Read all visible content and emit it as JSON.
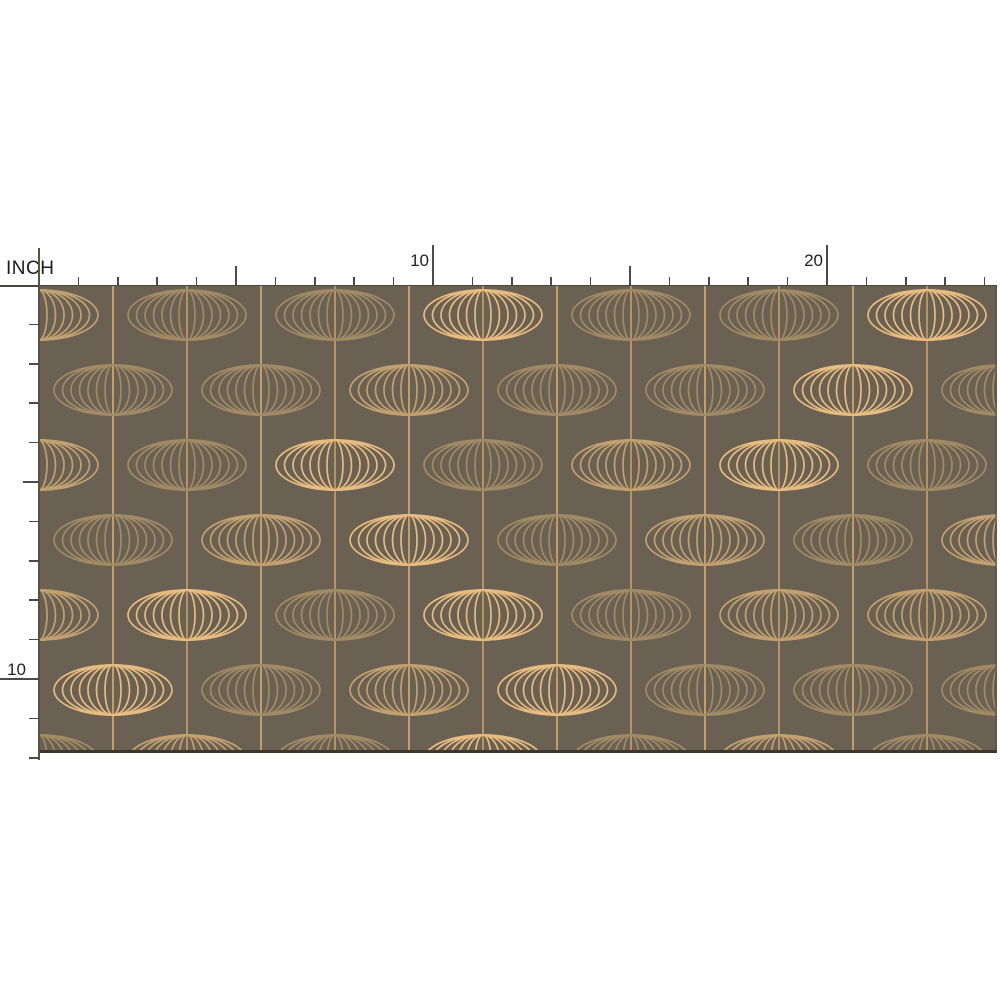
{
  "ruler": {
    "unit_label": "INCH",
    "px_per_inch": 39.4,
    "origin_x": 39,
    "origin_y": 285,
    "top_inches": 24,
    "side_inches": 12,
    "top_labels": [
      {
        "text": "10",
        "inch": 10
      },
      {
        "text": "20",
        "inch": 20
      }
    ],
    "side_labels": [
      {
        "text": "10",
        "inch": 10
      }
    ],
    "tick_color": "#4b4b4b",
    "line_color": "#4a463f"
  },
  "swatch": {
    "x": 40,
    "y": 286,
    "width": 957,
    "height": 466,
    "bg_color": "#6b6153",
    "string_colors": [
      "#c7a069",
      "#d7ad72"
    ],
    "string_first_x": -1,
    "string_spacing": 74,
    "string_count": 13,
    "tones": {
      "gold": "#e7bc80",
      "mid": "#c2a171",
      "tan": "#a18b66"
    },
    "lantern": {
      "ry": 25,
      "rx": [
        59,
        50.5,
        42,
        33.5,
        25,
        16.5,
        8
      ],
      "stroke_w": 1.7
    },
    "rows": [
      {
        "cy": 29,
        "xs": [
          -1,
          147,
          295,
          443,
          591,
          739,
          887
        ],
        "tones": [
          "mid",
          "tan",
          "tan",
          "gold",
          "tan",
          "tan",
          "gold"
        ]
      },
      {
        "cy": 104,
        "xs": [
          73,
          221,
          369,
          517,
          665,
          813,
          961
        ],
        "tones": [
          "tan",
          "tan",
          "mid",
          "tan",
          "tan",
          "gold",
          "tan"
        ]
      },
      {
        "cy": 179,
        "xs": [
          -1,
          147,
          295,
          443,
          591,
          739,
          887
        ],
        "tones": [
          "mid",
          "tan",
          "gold",
          "tan",
          "mid",
          "gold",
          "tan"
        ]
      },
      {
        "cy": 254,
        "xs": [
          73,
          221,
          369,
          517,
          665,
          813,
          961
        ],
        "tones": [
          "tan",
          "mid",
          "gold",
          "tan",
          "mid",
          "tan",
          "mid"
        ]
      },
      {
        "cy": 329,
        "xs": [
          -1,
          147,
          295,
          443,
          591,
          739,
          887
        ],
        "tones": [
          "mid",
          "gold",
          "tan",
          "gold",
          "tan",
          "mid",
          "mid"
        ]
      },
      {
        "cy": 404,
        "xs": [
          73,
          221,
          369,
          517,
          665,
          813,
          961
        ],
        "tones": [
          "gold",
          "tan",
          "mid",
          "gold",
          "tan",
          "tan",
          "tan"
        ]
      },
      {
        "cy": 474,
        "xs": [
          -1,
          147,
          295,
          443,
          591,
          739,
          887
        ],
        "tones": [
          "tan",
          "mid",
          "tan",
          "gold",
          "tan",
          "mid",
          "tan"
        ]
      }
    ]
  }
}
